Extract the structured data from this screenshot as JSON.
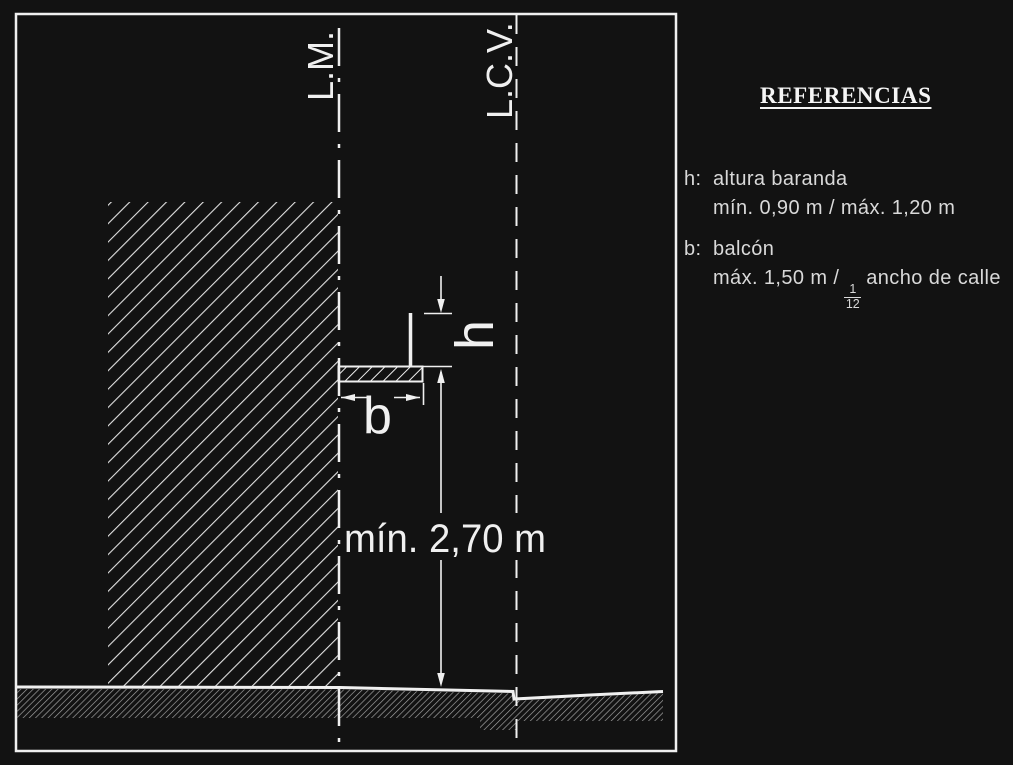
{
  "drawing": {
    "boundary_labels": {
      "property_line": "L.M.",
      "street_line": "L.C.V."
    },
    "dimensions": {
      "railing_height_symbol": "h",
      "balcony_depth_symbol": "b",
      "clearance": "mín. 2,70 m"
    }
  },
  "references": {
    "title": "REFERENCIAS",
    "items": [
      {
        "key": "h:",
        "term": "altura baranda",
        "detail": "mín. 0,90 m / máx. 1,20 m"
      },
      {
        "key": "b:",
        "term": "balcón",
        "detail_prefix": "máx. 1,50 m /",
        "fraction": {
          "numerator": "1",
          "denominator": "12"
        },
        "detail_suffix": "ancho de calle"
      }
    ]
  },
  "colors": {
    "background": "#121212",
    "line": "#f0f0f0",
    "text": "#d9d9d9",
    "ground_hatch": "#a8a8a8"
  }
}
